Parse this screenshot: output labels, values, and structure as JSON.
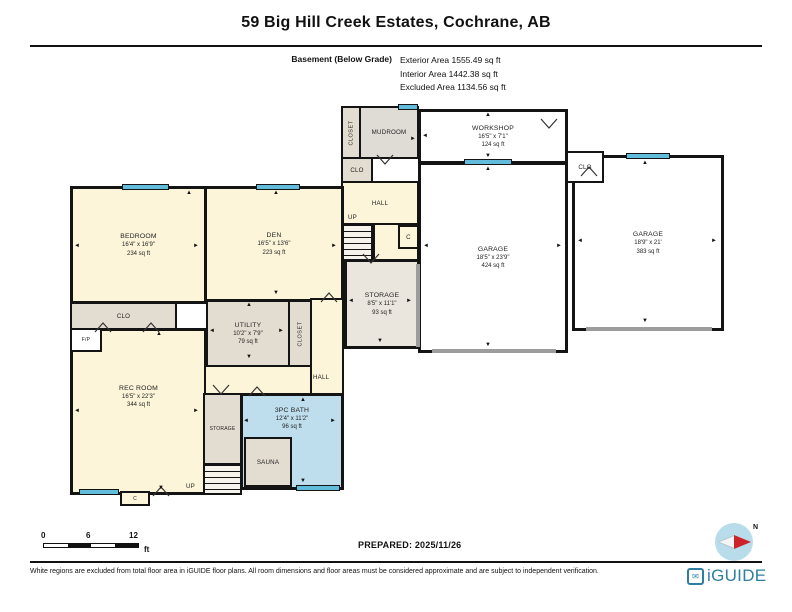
{
  "header": {
    "title": "59 Big Hill Creek Estates, Cochrane, AB",
    "floor_label": "Basement (Below Grade)",
    "areas": [
      "Exterior Area 1555.49 sq ft",
      "Interior Area 1442.38 sq ft",
      "Excluded Area 1134.56 sq ft"
    ]
  },
  "rooms": {
    "bedroom": {
      "name": "BEDROOM",
      "dims": "16'4\" x 16'9\"",
      "area": "234 sq ft"
    },
    "den": {
      "name": "DEN",
      "dims": "16'5\" x 13'6\"",
      "area": "223 sq ft"
    },
    "utility": {
      "name": "UTILITY",
      "dims": "10'2\" x 7'9\"",
      "area": "79 sq ft"
    },
    "rec_room": {
      "name": "REC ROOM",
      "dims": "16'5\" x 22'3\"",
      "area": "344 sq ft"
    },
    "bath": {
      "name": "3PC BATH",
      "dims": "12'4\" x 11'2\"",
      "area": "96 sq ft"
    },
    "storage_center": {
      "name": "STORAGE",
      "dims": "8'5\" x 11'1\"",
      "area": "93 sq ft"
    },
    "workshop": {
      "name": "WORKSHOP",
      "dims": "16'5\" x 7'1\"",
      "area": "124 sq ft"
    },
    "garage_main": {
      "name": "GARAGE",
      "dims": "18'5\" x 23'9\"",
      "area": "424 sq ft"
    },
    "garage_second": {
      "name": "GARAGE",
      "dims": "18'9\" x 21'",
      "area": "383 sq ft"
    },
    "sauna": {
      "name": "SAUNA"
    },
    "mudroom": {
      "name": "MUDROOM"
    }
  },
  "labels": {
    "clo": "CLO",
    "closet": "CLOSET",
    "storage": "STORAGE",
    "hall": "HALL",
    "up": "UP",
    "c": "C",
    "fp": "F/P"
  },
  "icons": {
    "up": "▲",
    "down": "▼",
    "left": "◄",
    "right": "►",
    "envelope": "✉"
  },
  "scale": {
    "t0": "0",
    "t6": "6",
    "t12": "12",
    "unit": "ft"
  },
  "prepared": "PREPARED: 2025/11/26",
  "compass": {
    "north": "N"
  },
  "footer": {
    "disclaimer": "White regions are excluded from total floor area in iGUIDE floor plans. All room dimensions and floor areas must be considered approximate and are subject to independent verification.",
    "brand": "iGUIDE"
  },
  "colors": {
    "accent_window": "#62bcdc",
    "brand_teal": "#2e7f9e",
    "bath_blue": "#bfdeed",
    "needle_red": "#cc2229"
  }
}
